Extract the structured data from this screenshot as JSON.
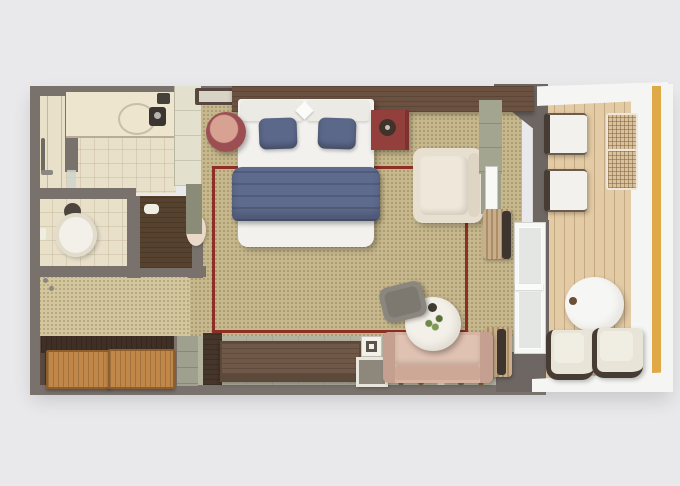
{
  "meta": {
    "type": "floor-plan",
    "subject": "Cruise ship veranda stateroom, top-down 3D rendered floor plan",
    "visible_text": "none"
  },
  "colors": {
    "bg": "#e9e9eb",
    "wall": "#78716c",
    "wall-dark": "#6d6662",
    "tile": "#e9e0ca",
    "carpet": "#c6b78c",
    "dressing-floor": "#d4c69c",
    "floor-strip": "#b4b3a0",
    "wood-floor": "#4f3e33",
    "rug-border": "#8e2f27",
    "headboard-wood": "#6b5140",
    "desk-wood": "#5d4939",
    "drawer-wood": "#c08749",
    "wardrobe-wood": "#57422f",
    "duvet": "#f2f1ee",
    "bedding-blue": "#5c688a",
    "blanket-blue": "#5f6b8e",
    "nightstand-maroon": "#9c4f52",
    "nightstand-red": "#93403c",
    "armchair-cream": "#e7dfd0",
    "sofa-rose": "#d7b3a2",
    "sage": "#a3a590",
    "sage-dark": "#8a8c78",
    "cabinet-pale": "#e3e1ce",
    "mirror-white": "#f8f8f6",
    "curtain": "#c9ae8c",
    "deck": "#e3cba5",
    "wicker": "#d8c29e",
    "white-deck": "#f5f5f3",
    "accent-yellow": "#dfa948",
    "glass": "#e3e6e2",
    "chair-gray": "#8b867e",
    "table-white": "#f3f0e9",
    "frame-dark": "#473c33",
    "toilet-white": "#f3f0e9",
    "plant-green": "#6e8a4b"
  },
  "plan": {
    "rooms": [
      {
        "id": "shower-room",
        "label": "Walk-in shower room"
      },
      {
        "id": "vanity-room",
        "label": "Bathroom vanity with sink"
      },
      {
        "id": "wc-room",
        "label": "Toilet room"
      },
      {
        "id": "dressing-area",
        "label": "Dressing and closet area"
      },
      {
        "id": "entry",
        "label": "Entry hall"
      },
      {
        "id": "main-cabin",
        "label": "Main cabin with queen bed and sitting area"
      },
      {
        "id": "balcony",
        "label": "Private veranda balcony"
      }
    ],
    "furniture": {
      "bed": "Queen bed with white duvet, two blue pillows and blue throw blanket",
      "nightstand_left": "Round maroon nightstand",
      "nightstand_right": "Square maroon nightstand with lamp",
      "armchair": "Cream armchair",
      "sofa": "Rose upholstered sofa",
      "coffee_table": "Round white coffee table with plant",
      "side_chair": "Gray chair",
      "desk": "Long dark wood dresser desk",
      "drawers": "Two light wood drawer chests",
      "wardrobe": "Dark wood wardrobe shelves",
      "tall_cabinet": "Tall pale cabinet",
      "tv_console": "Sage console with mirror",
      "toilet": "Toilet",
      "vanity_counter": "Vanity counter with sink and faucet",
      "shower_fixture": "Shower fixture",
      "rug": "Area rug with dark red border",
      "curtain_top": "Curtain bundle (upper)",
      "curtain_bottom": "Curtain bundle (lower)",
      "balcony_door": "Sliding glass balcony door",
      "entry_door": "Entry door",
      "lounger_1": "Balcony lounge chair 1",
      "lounger_2": "Balcony lounge chair 2",
      "wicker_stool_1": "Wicker footstool 1",
      "wicker_stool_2": "Wicker footstool 2",
      "balcony_table": "Round balcony table",
      "balcony_chair_1": "Balcony chair 1",
      "balcony_chair_2": "Balcony chair 2",
      "railing": "Balcony railing with yellow ship accent stripe"
    }
  }
}
